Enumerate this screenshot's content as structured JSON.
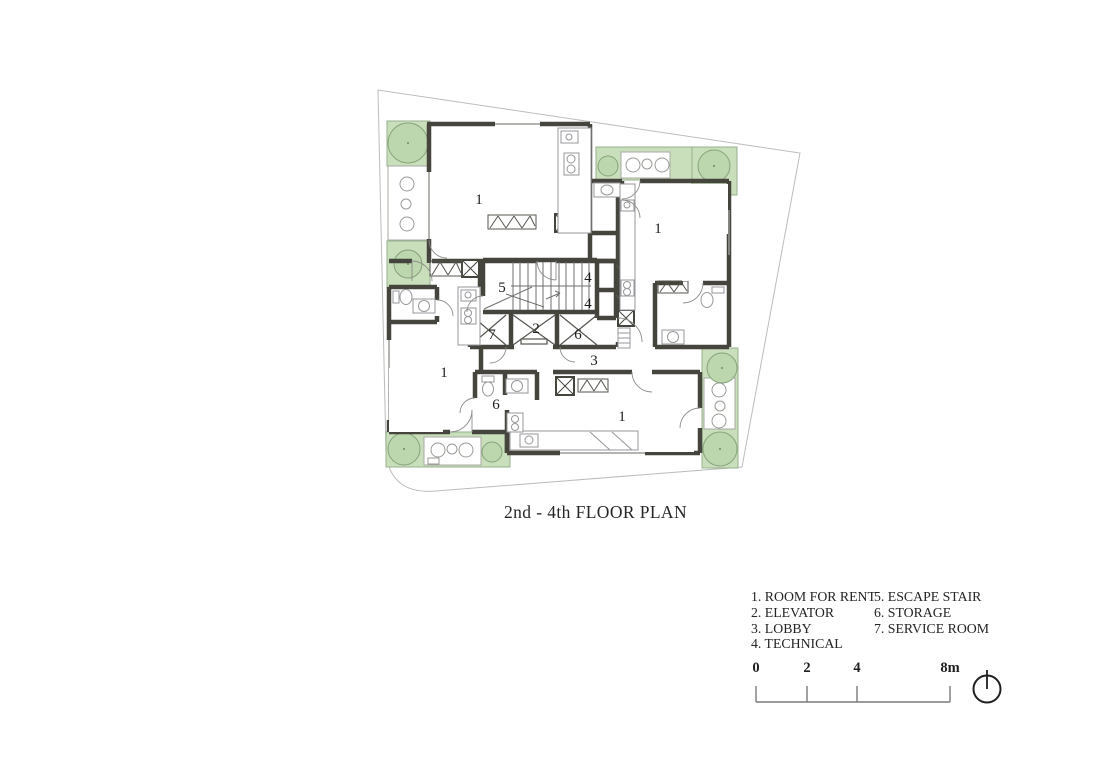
{
  "title": "2nd - 4th FLOOR PLAN",
  "legend": {
    "column1": [
      "1. ROOM FOR RENT",
      "2. ELEVATOR",
      "3. LOBBY",
      "4. TECHNICAL"
    ],
    "column2": [
      "5. ESCAPE STAIR",
      "6. STORAGE",
      "7. SERVICE ROOM"
    ]
  },
  "scale_bar": {
    "ticks": [
      "0",
      "2",
      "4",
      "8m"
    ]
  },
  "plan": {
    "labels": {
      "room_tl": "1",
      "room_tr": "1",
      "room_bl": "1",
      "room_br": "1",
      "elevator": "2",
      "lobby": "3",
      "technical_upper": "4",
      "technical_lower": "4",
      "escape_stair": "5",
      "storage_core": "6",
      "storage_unit": "6",
      "service_room": "7"
    }
  },
  "colors": {
    "greenery": "#c9dfbb",
    "tree": "#bcd6ae",
    "walls": "#45453e",
    "boundary": "#bcbcbc"
  }
}
